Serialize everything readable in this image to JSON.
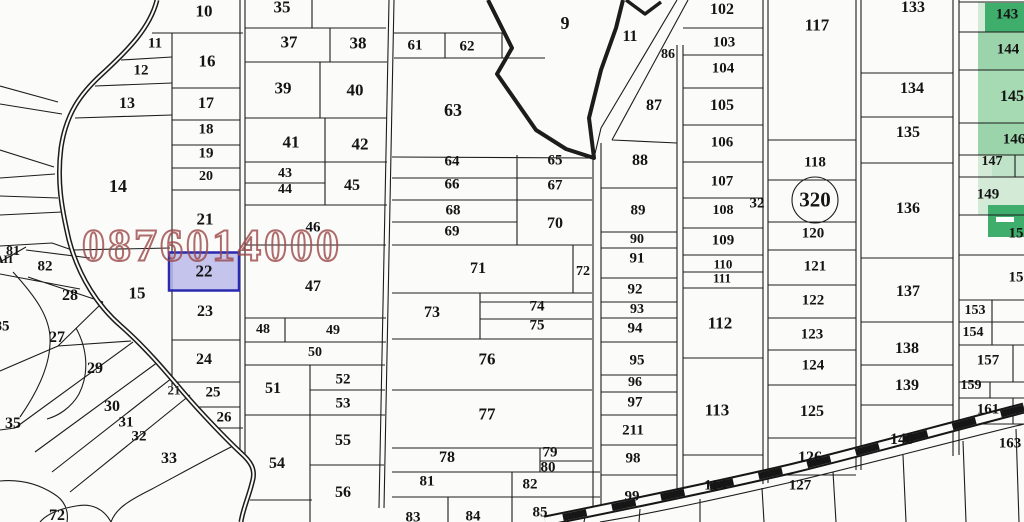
{
  "watermark": {
    "text": "0876014000",
    "color": "#9c4848"
  },
  "selected_parcel": {
    "id": "22",
    "fill": "#b7b7e9",
    "border": "#2a2ab0"
  },
  "sheet_circle": {
    "text": "320"
  },
  "colors": {
    "bg": "#fbfbfa",
    "line": "#1c1c1c",
    "green_dark": "#3fae6d",
    "green_mid": "#9bd3aa",
    "green_mid2": "#a6dab3",
    "green_light": "#d2ead6",
    "green_pale": "#bfe3c8"
  },
  "map": {
    "labels": [
      {
        "t": "10",
        "x": 204,
        "y": 11,
        "s": 17
      },
      {
        "t": "35",
        "x": 282,
        "y": 7,
        "s": 17
      },
      {
        "t": "11",
        "x": 155,
        "y": 44,
        "s": 15
      },
      {
        "t": "16",
        "x": 207,
        "y": 61,
        "s": 17
      },
      {
        "t": "37",
        "x": 289,
        "y": 42,
        "s": 17
      },
      {
        "t": "38",
        "x": 358,
        "y": 43,
        "s": 17
      },
      {
        "t": "12",
        "x": 141,
        "y": 71,
        "s": 15
      },
      {
        "t": "39",
        "x": 283,
        "y": 88,
        "s": 17
      },
      {
        "t": "40",
        "x": 355,
        "y": 90,
        "s": 17
      },
      {
        "t": "13",
        "x": 127,
        "y": 104,
        "s": 16
      },
      {
        "t": "17",
        "x": 206,
        "y": 104,
        "s": 16
      },
      {
        "t": "18",
        "x": 206,
        "y": 130,
        "s": 15
      },
      {
        "t": "19",
        "x": 206,
        "y": 154,
        "s": 15
      },
      {
        "t": "41",
        "x": 291,
        "y": 142,
        "s": 17
      },
      {
        "t": "42",
        "x": 360,
        "y": 144,
        "s": 17
      },
      {
        "t": "20",
        "x": 206,
        "y": 177,
        "s": 14
      },
      {
        "t": "43",
        "x": 285,
        "y": 174,
        "s": 14
      },
      {
        "t": "44",
        "x": 285,
        "y": 190,
        "s": 14
      },
      {
        "t": "45",
        "x": 352,
        "y": 186,
        "s": 16
      },
      {
        "t": "14",
        "x": 118,
        "y": 186,
        "s": 18
      },
      {
        "t": "21",
        "x": 205,
        "y": 219,
        "s": 17
      },
      {
        "t": "46",
        "x": 313,
        "y": 228,
        "s": 15
      },
      {
        "t": "61",
        "x": 415,
        "y": 46,
        "s": 15
      },
      {
        "t": "62",
        "x": 467,
        "y": 47,
        "s": 15
      },
      {
        "t": "9",
        "x": 565,
        "y": 23,
        "s": 18
      },
      {
        "t": "11",
        "x": 630,
        "y": 37,
        "s": 16
      },
      {
        "t": "86",
        "x": 668,
        "y": 55,
        "s": 14
      },
      {
        "t": "63",
        "x": 453,
        "y": 110,
        "s": 18
      },
      {
        "t": "87",
        "x": 654,
        "y": 106,
        "s": 16
      },
      {
        "t": "64",
        "x": 452,
        "y": 162,
        "s": 15
      },
      {
        "t": "65",
        "x": 555,
        "y": 161,
        "s": 15
      },
      {
        "t": "88",
        "x": 640,
        "y": 161,
        "s": 16
      },
      {
        "t": "66",
        "x": 452,
        "y": 185,
        "s": 15
      },
      {
        "t": "67",
        "x": 555,
        "y": 186,
        "s": 15
      },
      {
        "t": "68",
        "x": 453,
        "y": 211,
        "s": 15
      },
      {
        "t": "70",
        "x": 555,
        "y": 224,
        "s": 16
      },
      {
        "t": "69",
        "x": 452,
        "y": 232,
        "s": 15
      },
      {
        "t": "89",
        "x": 638,
        "y": 211,
        "s": 15
      },
      {
        "t": "90",
        "x": 637,
        "y": 240,
        "s": 14
      },
      {
        "t": "91",
        "x": 637,
        "y": 259,
        "s": 15
      },
      {
        "t": "92",
        "x": 635,
        "y": 290,
        "s": 15
      },
      {
        "t": "93",
        "x": 637,
        "y": 310,
        "s": 14
      },
      {
        "t": "94",
        "x": 635,
        "y": 329,
        "s": 15
      },
      {
        "t": "95",
        "x": 637,
        "y": 361,
        "s": 15
      },
      {
        "t": "96",
        "x": 635,
        "y": 383,
        "s": 14
      },
      {
        "t": "97",
        "x": 635,
        "y": 403,
        "s": 15
      },
      {
        "t": "211",
        "x": 633,
        "y": 431,
        "s": 15
      },
      {
        "t": "98",
        "x": 633,
        "y": 459,
        "s": 15
      },
      {
        "t": "99",
        "x": 632,
        "y": 497,
        "s": 15
      },
      {
        "t": "72",
        "x": 583,
        "y": 272,
        "s": 14
      },
      {
        "t": "71",
        "x": 478,
        "y": 269,
        "s": 16
      },
      {
        "t": "47",
        "x": 313,
        "y": 287,
        "s": 16
      },
      {
        "t": "73",
        "x": 432,
        "y": 313,
        "s": 16
      },
      {
        "t": "74",
        "x": 537,
        "y": 307,
        "s": 15
      },
      {
        "t": "75",
        "x": 537,
        "y": 326,
        "s": 15
      },
      {
        "t": "48",
        "x": 263,
        "y": 330,
        "s": 14
      },
      {
        "t": "49",
        "x": 333,
        "y": 331,
        "s": 14
      },
      {
        "t": "50",
        "x": 315,
        "y": 353,
        "s": 14
      },
      {
        "t": "76",
        "x": 487,
        "y": 359,
        "s": 17
      },
      {
        "t": "52",
        "x": 343,
        "y": 380,
        "s": 15
      },
      {
        "t": "53",
        "x": 343,
        "y": 404,
        "s": 15
      },
      {
        "t": "51",
        "x": 273,
        "y": 389,
        "s": 16
      },
      {
        "t": "77",
        "x": 487,
        "y": 414,
        "s": 17
      },
      {
        "t": "55",
        "x": 343,
        "y": 441,
        "s": 16
      },
      {
        "t": "54",
        "x": 277,
        "y": 464,
        "s": 16
      },
      {
        "t": "56",
        "x": 343,
        "y": 493,
        "s": 16
      },
      {
        "t": "78",
        "x": 447,
        "y": 458,
        "s": 16
      },
      {
        "t": "79",
        "x": 550,
        "y": 453,
        "s": 15
      },
      {
        "t": "80",
        "x": 548,
        "y": 468,
        "s": 15
      },
      {
        "t": "81",
        "x": 427,
        "y": 482,
        "s": 15
      },
      {
        "t": "82",
        "x": 530,
        "y": 485,
        "s": 15
      },
      {
        "t": "83",
        "x": 413,
        "y": 518,
        "s": 15
      },
      {
        "t": "84",
        "x": 473,
        "y": 517,
        "s": 15
      },
      {
        "t": "85",
        "x": 540,
        "y": 513,
        "s": 15
      },
      {
        "t": "22",
        "x": 204,
        "y": 271,
        "s": 17
      },
      {
        "t": "23",
        "x": 205,
        "y": 312,
        "s": 16
      },
      {
        "t": "24",
        "x": 204,
        "y": 360,
        "s": 16
      },
      {
        "t": "25",
        "x": 213,
        "y": 393,
        "s": 15
      },
      {
        "t": "26",
        "x": 224,
        "y": 418,
        "s": 15
      },
      {
        "t": "15",
        "x": 137,
        "y": 293,
        "s": 17
      },
      {
        "t": "28",
        "x": 70,
        "y": 296,
        "s": 16
      },
      {
        "t": "27",
        "x": 57,
        "y": 338,
        "s": 16
      },
      {
        "t": "82",
        "x": 45,
        "y": 267,
        "s": 15
      },
      {
        "t": "81",
        "x": 13,
        "y": 252,
        "s": 14
      },
      {
        "t": "АП",
        "x": 4,
        "y": 259,
        "s": 12
      },
      {
        "t": "85",
        "x": 2,
        "y": 327,
        "s": 15
      },
      {
        "t": "35",
        "x": 13,
        "y": 424,
        "s": 16
      },
      {
        "t": "29",
        "x": 95,
        "y": 369,
        "s": 16
      },
      {
        "t": "30",
        "x": 112,
        "y": 407,
        "s": 16
      },
      {
        "t": "31",
        "x": 126,
        "y": 423,
        "s": 15
      },
      {
        "t": "32",
        "x": 139,
        "y": 437,
        "s": 15
      },
      {
        "t": "33",
        "x": 169,
        "y": 459,
        "s": 16
      },
      {
        "t": "72",
        "x": 57,
        "y": 516,
        "s": 16
      },
      {
        "t": "21",
        "x": 174,
        "y": 390,
        "s": 13,
        "c": "#2b2b2b"
      },
      {
        "t": "102",
        "x": 722,
        "y": 10,
        "s": 16
      },
      {
        "t": "103",
        "x": 724,
        "y": 43,
        "s": 15
      },
      {
        "t": "104",
        "x": 723,
        "y": 69,
        "s": 15
      },
      {
        "t": "105",
        "x": 722,
        "y": 106,
        "s": 16
      },
      {
        "t": "106",
        "x": 722,
        "y": 143,
        "s": 15
      },
      {
        "t": "107",
        "x": 722,
        "y": 182,
        "s": 15
      },
      {
        "t": "108",
        "x": 723,
        "y": 211,
        "s": 14
      },
      {
        "t": "109",
        "x": 723,
        "y": 241,
        "s": 15
      },
      {
        "t": "110",
        "x": 723,
        "y": 264,
        "s": 13
      },
      {
        "t": "111",
        "x": 722,
        "y": 278,
        "s": 13
      },
      {
        "t": "112",
        "x": 720,
        "y": 323,
        "s": 17
      },
      {
        "t": "113",
        "x": 717,
        "y": 410,
        "s": 17
      },
      {
        "t": "114",
        "x": 715,
        "y": 486,
        "s": 15
      },
      {
        "t": "117",
        "x": 817,
        "y": 25,
        "s": 17
      },
      {
        "t": "118",
        "x": 815,
        "y": 163,
        "s": 15
      },
      {
        "t": "120",
        "x": 813,
        "y": 234,
        "s": 15
      },
      {
        "t": "121",
        "x": 815,
        "y": 267,
        "s": 15
      },
      {
        "t": "122",
        "x": 813,
        "y": 301,
        "s": 15
      },
      {
        "t": "123",
        "x": 812,
        "y": 335,
        "s": 15
      },
      {
        "t": "124",
        "x": 813,
        "y": 366,
        "s": 15
      },
      {
        "t": "125",
        "x": 812,
        "y": 412,
        "s": 16
      },
      {
        "t": "126",
        "x": 810,
        "y": 458,
        "s": 16
      },
      {
        "t": "127",
        "x": 800,
        "y": 486,
        "s": 15
      },
      {
        "t": "32",
        "x": 757,
        "y": 204,
        "s": 15
      },
      {
        "t": "133",
        "x": 913,
        "y": 8,
        "s": 16
      },
      {
        "t": "134",
        "x": 912,
        "y": 89,
        "s": 16
      },
      {
        "t": "135",
        "x": 908,
        "y": 133,
        "s": 16
      },
      {
        "t": "136",
        "x": 908,
        "y": 209,
        "s": 16
      },
      {
        "t": "137",
        "x": 908,
        "y": 292,
        "s": 16
      },
      {
        "t": "138",
        "x": 907,
        "y": 349,
        "s": 16
      },
      {
        "t": "139",
        "x": 907,
        "y": 386,
        "s": 16
      },
      {
        "t": "140",
        "x": 902,
        "y": 440,
        "s": 16
      },
      {
        "t": "143",
        "x": 1007,
        "y": 15,
        "s": 15
      },
      {
        "t": "144",
        "x": 1008,
        "y": 50,
        "s": 15
      },
      {
        "t": "145",
        "x": 1012,
        "y": 97,
        "s": 16
      },
      {
        "t": "146",
        "x": 1014,
        "y": 140,
        "s": 15
      },
      {
        "t": "147",
        "x": 992,
        "y": 162,
        "s": 14
      },
      {
        "t": "149",
        "x": 988,
        "y": 195,
        "s": 15
      },
      {
        "t": "15",
        "x": 1016,
        "y": 234,
        "s": 15
      },
      {
        "t": "15",
        "x": 1016,
        "y": 278,
        "s": 15
      },
      {
        "t": "153",
        "x": 975,
        "y": 311,
        "s": 14
      },
      {
        "t": "154",
        "x": 973,
        "y": 333,
        "s": 14
      },
      {
        "t": "157",
        "x": 988,
        "y": 361,
        "s": 15
      },
      {
        "t": "159",
        "x": 971,
        "y": 386,
        "s": 14
      },
      {
        "t": "161",
        "x": 988,
        "y": 410,
        "s": 15
      },
      {
        "t": "163",
        "x": 1010,
        "y": 444,
        "s": 15
      }
    ]
  }
}
